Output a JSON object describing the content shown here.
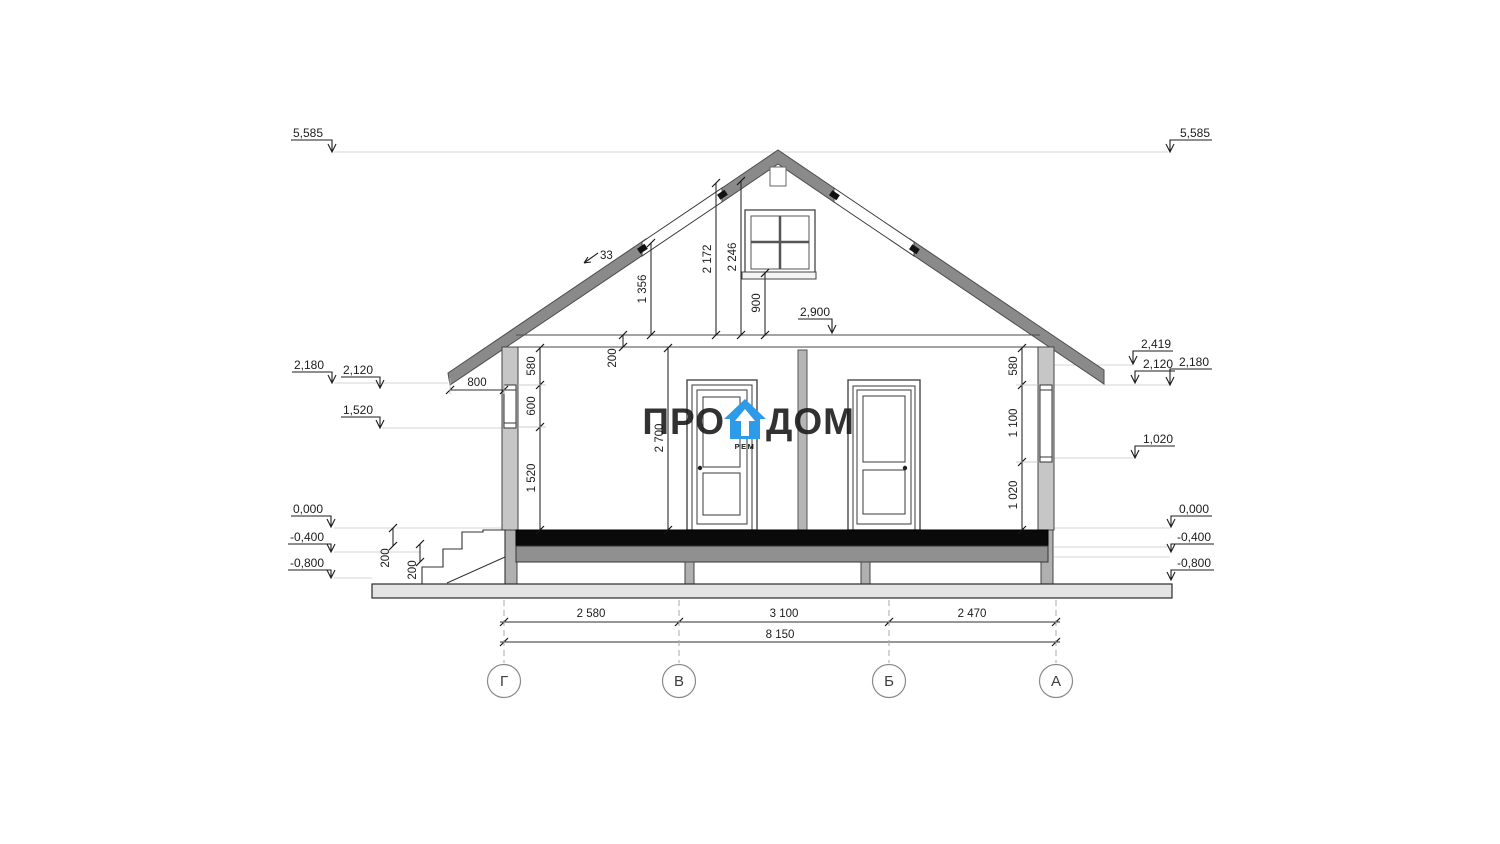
{
  "levels": {
    "left": [
      {
        "id": "ridge",
        "value": "5,585"
      },
      {
        "id": "eave",
        "value": "2,180"
      },
      {
        "id": "window-head",
        "value": "2,120"
      },
      {
        "id": "window-sill",
        "value": "1,520"
      },
      {
        "id": "floor",
        "value": "0,000"
      },
      {
        "id": "plinth",
        "value": "-0,400"
      },
      {
        "id": "ground",
        "value": "-0,800"
      }
    ],
    "right": [
      {
        "id": "ridge",
        "value": "5,585"
      },
      {
        "id": "eave-top",
        "value": "2,419"
      },
      {
        "id": "window-head",
        "value": "2,120"
      },
      {
        "id": "ceiling",
        "value": "2,180"
      },
      {
        "id": "window-sill",
        "value": "1,020"
      },
      {
        "id": "floor",
        "value": "0,000"
      },
      {
        "id": "plinth",
        "value": "-0,400"
      },
      {
        "id": "ground",
        "value": "-0,800"
      }
    ],
    "ceiling": "2,900"
  },
  "dimensions": {
    "rafter_drop": "1 356",
    "gable_height_inner": "2 172",
    "gable_height_ridge": "2 246",
    "gable_window_sill": "900",
    "roof_angle": "33",
    "eave_overhang": "800",
    "ceiling_thickness": "200",
    "left_chain": {
      "top": "580",
      "window": "600",
      "sill": "1 520"
    },
    "room_height": "2 700",
    "right_chain": {
      "top": "580",
      "window": "1 100",
      "sill": "1 020"
    },
    "stair_riser_1": "200",
    "stair_riser_2": "200",
    "span_g_v": "2 580",
    "span_v_b": "3 100",
    "span_b_a": "2 470",
    "span_total": "8 150"
  },
  "axes": [
    {
      "label": "Г"
    },
    {
      "label": "В"
    },
    {
      "label": "Б"
    },
    {
      "label": "А"
    }
  ],
  "watermark": {
    "word1": "ПРО",
    "word2": "ДОМ",
    "subtext": "РЕМ"
  },
  "colors": {
    "roof_fill": "#8a8a8a",
    "wall_fill": "#c6c6c6",
    "partition_fill": "#b5b5b5",
    "floor_fill": "#0a0a0a",
    "joist_fill": "#909090",
    "post_fill": "#b0b0b0",
    "ground_fill": "#e4e4e4",
    "brand_blue": "#2d9be8",
    "watermark_gray": "#3f3f3f"
  }
}
